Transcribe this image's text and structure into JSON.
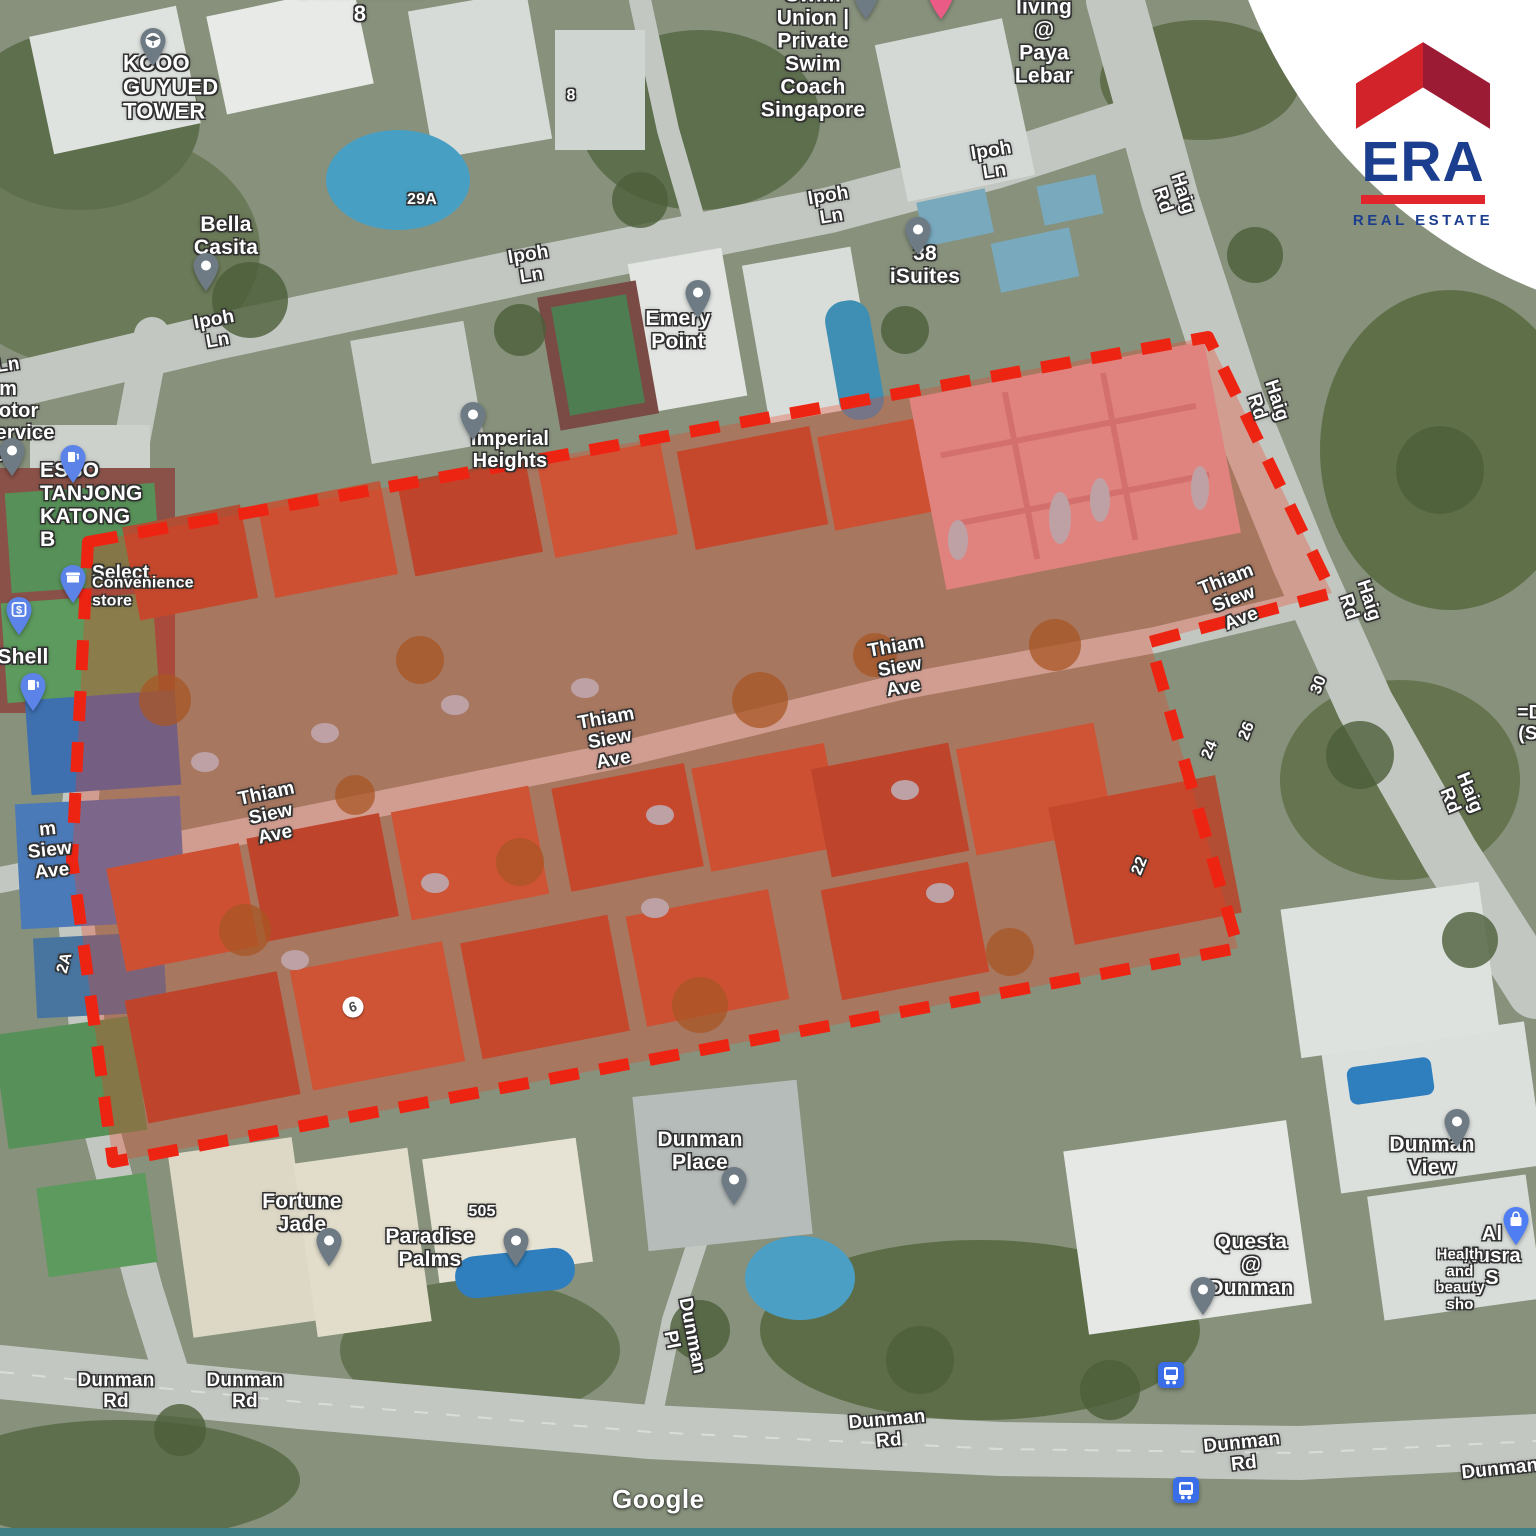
{
  "branding": {
    "name": "ERA",
    "tagline": "REAL ESTATE",
    "roof_left_color": "#d2232a",
    "roof_right_color": "#9a1b33",
    "text_color": "#1c3e8e",
    "bar_color": "#e0262c"
  },
  "parcel": {
    "outline_color": "#ee2413",
    "fill_color": "#f23b21",
    "fill_opacity": 0.3,
    "points": "88,542 1208,337 1332,593 1150,642 1238,948 113,1162 72,860"
  },
  "map": {
    "attribution": "Google",
    "road_labels": [
      {
        "text": "Ipoh Ln",
        "x": 216,
        "y": 331,
        "rot": -10
      },
      {
        "text": "Ipoh Ln",
        "x": 530,
        "y": 266,
        "rot": -9
      },
      {
        "text": "Ipoh Ln",
        "x": 830,
        "y": 207,
        "rot": -9
      },
      {
        "text": "Ipoh Ln",
        "x": 993,
        "y": 162,
        "rot": -9
      },
      {
        "text": "Haig Rd",
        "x": 1172,
        "y": 197,
        "rot": 72
      },
      {
        "text": "Haig Rd",
        "x": 1266,
        "y": 404,
        "rot": 72
      },
      {
        "text": "Haig Rd",
        "x": 1358,
        "y": 604,
        "rot": 72
      },
      {
        "text": "Haig Rd",
        "x": 1459,
        "y": 797,
        "rot": 68
      },
      {
        "text": "Thiam Siew Ave",
        "x": 271,
        "y": 815,
        "rot": -12
      },
      {
        "text": "Thiam Siew Ave",
        "x": 610,
        "y": 740,
        "rot": -10
      },
      {
        "text": "Thiam Siew Ave",
        "x": 900,
        "y": 668,
        "rot": -10
      },
      {
        "text": "Thiam Siew Ave",
        "x": 1234,
        "y": 600,
        "rot": -21
      },
      {
        "text": "m Siew Ave",
        "x": 50,
        "y": 851,
        "rot": -6
      },
      {
        "text": "Ln",
        "x": 8,
        "y": 366,
        "rot": -8
      },
      {
        "text": "Dunman Rd",
        "x": 116,
        "y": 1392
      },
      {
        "text": "Dunman Rd",
        "x": 245,
        "y": 1392
      },
      {
        "text": "Dunman Rd",
        "x": 888,
        "y": 1431,
        "rot": -5
      },
      {
        "text": "Dunman Rd",
        "x": 1243,
        "y": 1454,
        "rot": -6
      },
      {
        "text": "Dunman",
        "x": 1500,
        "y": 1470,
        "rot": -6
      },
      {
        "text": "Dunman Pl",
        "x": 681,
        "y": 1338,
        "rot": 79
      }
    ],
    "poi_labels": [
      {
        "text": "Butterworth 8",
        "x": 360,
        "y": 2,
        "size": 22
      },
      {
        "text": "KCOO GUYUED\nTOWER",
        "x": 123,
        "y": 88,
        "align": "left",
        "size": 22
      },
      {
        "text": "Bella Casita",
        "x": 226,
        "y": 236
      },
      {
        "text": "Swim Union | Private\nSwim Coach Singapore",
        "x": 813,
        "y": 53
      },
      {
        "text": "Co-living @ Paya Lebar",
        "x": 1044,
        "y": 30
      },
      {
        "text": "38 iSuites",
        "x": 925,
        "y": 265
      },
      {
        "text": "Emery Point",
        "x": 678,
        "y": 330
      },
      {
        "text": "Imperial Heights",
        "x": 510,
        "y": 450,
        "size": 20
      },
      {
        "text": "iam Motor Service Pte",
        "x": -18,
        "y": 422,
        "align": "left",
        "size": 20
      },
      {
        "text": "ESSO TANJONG\nKATONG B",
        "x": 40,
        "y": 505,
        "align": "left"
      },
      {
        "text": "Select",
        "x": 92,
        "y": 574,
        "align": "left",
        "size": 19
      },
      {
        "text": "Convenience store",
        "x": 92,
        "y": 592,
        "align": "left",
        "size": 16
      },
      {
        "text": "Shell",
        "x": 23,
        "y": 657
      },
      {
        "text": "=D",
        "x": 1530,
        "y": 714,
        "size": 19
      },
      {
        "text": "(S",
        "x": 1528,
        "y": 735,
        "size": 19
      },
      {
        "text": "Fortune Jade",
        "x": 302,
        "y": 1213
      },
      {
        "text": "Paradise Palms",
        "x": 430,
        "y": 1248
      },
      {
        "text": "Dunman Place",
        "x": 700,
        "y": 1151
      },
      {
        "text": "Dunman View",
        "x": 1432,
        "y": 1156
      },
      {
        "text": "Questa @ Dunman",
        "x": 1251,
        "y": 1265
      },
      {
        "text": "Al Nusra S",
        "x": 1492,
        "y": 1256,
        "size": 20
      },
      {
        "text": "Health and beauty sho",
        "x": 1460,
        "y": 1280,
        "size": 15
      }
    ],
    "number_labels": [
      {
        "text": "8",
        "x": 571,
        "y": 96
      },
      {
        "text": "29A",
        "x": 422,
        "y": 200
      },
      {
        "text": "505",
        "x": 482,
        "y": 1212
      },
      {
        "text": "30",
        "x": 1319,
        "y": 685,
        "rot": -68
      },
      {
        "text": "26",
        "x": 1247,
        "y": 731,
        "rot": -68
      },
      {
        "text": "24",
        "x": 1210,
        "y": 750,
        "rot": -68
      },
      {
        "text": "22",
        "x": 1140,
        "y": 866,
        "rot": -68
      },
      {
        "text": "2A",
        "x": 65,
        "y": 963,
        "rot": -75
      },
      {
        "text": "6",
        "x": 353,
        "y": 1007,
        "rot": -15,
        "badge": true
      }
    ],
    "pins": [
      {
        "type": "graduation-pin",
        "for": "kcoo-guyued-tower",
        "x": 153,
        "y": 27
      },
      {
        "type": "location-pin",
        "for": "bella-casita",
        "x": 206,
        "y": 252
      },
      {
        "type": "location-pin",
        "for": "swim-union",
        "x": 866,
        "y": -20
      },
      {
        "type": "coliving-pin",
        "for": "co-living-paya-lebar",
        "x": 941,
        "y": -20
      },
      {
        "type": "location-pin",
        "for": "38-isuites",
        "x": 918,
        "y": 216
      },
      {
        "type": "location-pin",
        "for": "emery-point",
        "x": 698,
        "y": 279
      },
      {
        "type": "location-pin",
        "for": "imperial-heights",
        "x": 473,
        "y": 401
      },
      {
        "type": "location-pin",
        "for": "motor-service",
        "x": 12,
        "y": 437
      },
      {
        "type": "fuel-pin",
        "for": "esso-tanjong-katong",
        "x": 73,
        "y": 444
      },
      {
        "type": "store-pin",
        "for": "select-convenience",
        "x": 73,
        "y": 564
      },
      {
        "type": "atm-pin",
        "for": "atm",
        "x": 19,
        "y": 596
      },
      {
        "type": "fuel-pin",
        "for": "shell",
        "x": 33,
        "y": 672
      },
      {
        "type": "location-pin",
        "for": "fortune-jade",
        "x": 329,
        "y": 1227
      },
      {
        "type": "location-pin",
        "for": "paradise-palms",
        "x": 516,
        "y": 1227
      },
      {
        "type": "location-pin",
        "for": "dunman-place",
        "x": 734,
        "y": 1166
      },
      {
        "type": "location-pin",
        "for": "dunman-view",
        "x": 1457,
        "y": 1108
      },
      {
        "type": "location-pin",
        "for": "questa-dunman",
        "x": 1203,
        "y": 1276
      },
      {
        "type": "shopping-pin",
        "for": "al-nusra",
        "x": 1516,
        "y": 1206
      },
      {
        "type": "bus-stop-icon",
        "for": "bus-stop-1",
        "x": 1171,
        "y": 1362
      },
      {
        "type": "bus-stop-icon",
        "for": "bus-stop-2",
        "x": 1186,
        "y": 1477
      }
    ]
  }
}
